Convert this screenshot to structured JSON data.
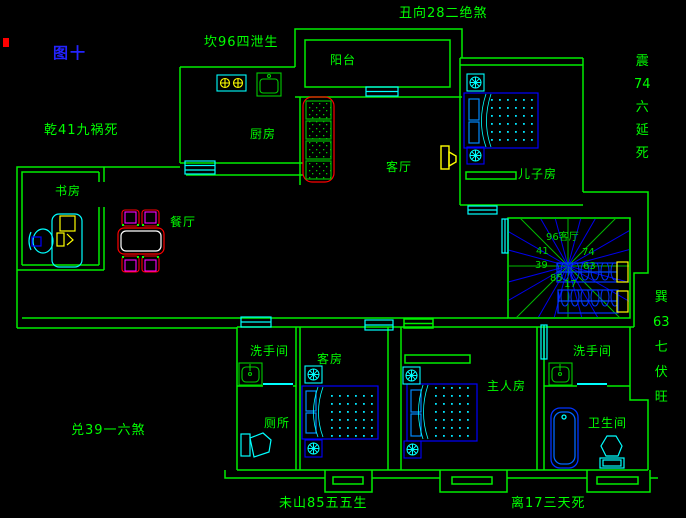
{
  "figure": {
    "label": "图十"
  },
  "fengshui": {
    "north": "坎96四泄生",
    "northeast": "丑向28二绝煞",
    "northwest": "乾41九祸死",
    "west": "兑39一六煞",
    "southwest": "未山85五五生",
    "south": "离17三天死",
    "east": [
      "震",
      "74",
      "六",
      "延",
      "死"
    ],
    "southeast": [
      "巽",
      "63",
      "七",
      "伏",
      "旺"
    ]
  },
  "rooms": {
    "balcony": "阳台",
    "kitchen": "厨房",
    "living": "客厅",
    "sons_room": "儿子房",
    "study": "书房",
    "dining": "餐厅",
    "washroom_left": "洗手间",
    "toilet_room": "厕所",
    "guest_room": "客房",
    "master_room": "主人房",
    "washroom_right": "洗手间",
    "bathroom": "卫生间"
  },
  "compass": {
    "sector_label": "96客厅",
    "numbers": [
      "41",
      "74",
      "39",
      "63",
      "85",
      "17"
    ]
  },
  "colors": {
    "background": "#000000",
    "wall": "#00ee00",
    "fixture": "#00ffff",
    "furniture": "#0000ff",
    "sofa": "#ff0000",
    "chair": "#ff00ff",
    "accent": "#ffff00",
    "title": "#2323ff"
  }
}
